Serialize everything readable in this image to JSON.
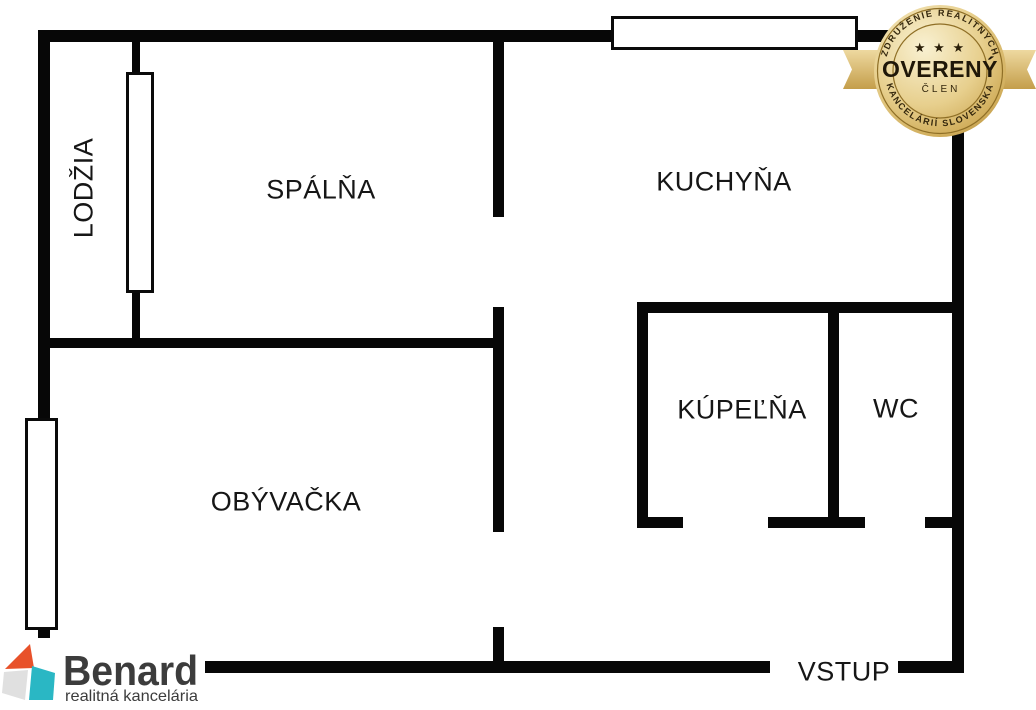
{
  "floorplan": {
    "wall_color": "#070707",
    "rooms": {
      "lodzia": "LODŽIA",
      "spalna": "SPÁLŇA",
      "kuchyna": "KUCHYŇA",
      "kupelna": "KÚPEĽŇA",
      "wc": "WC",
      "obyvacka": "OBÝVAČKA"
    },
    "entrance_label": "VSTUP"
  },
  "logo": {
    "name": "Benard",
    "tagline": "realitná kancelária",
    "colors": {
      "roof": "#e8512a",
      "left_face": "#e0e0e0",
      "right_face": "#2ab7c4",
      "text": "#3c3c3c"
    }
  },
  "badge": {
    "arc_top": "ZDRUŽENIE REALITNÝCH",
    "arc_bottom": "KANCELÁRIÍ SLOVENSKA",
    "stars": "★ ★ ★",
    "title": "OVERENÝ",
    "subtitle": "ČLEN",
    "colors": {
      "gold_light": "#f9f1d2",
      "gold_mid": "#e7cf8d",
      "gold_dark": "#b38e3d",
      "ribbon_light": "#eed9a0",
      "ribbon_dark": "#c49e4a",
      "text": "#2a1e08"
    }
  }
}
